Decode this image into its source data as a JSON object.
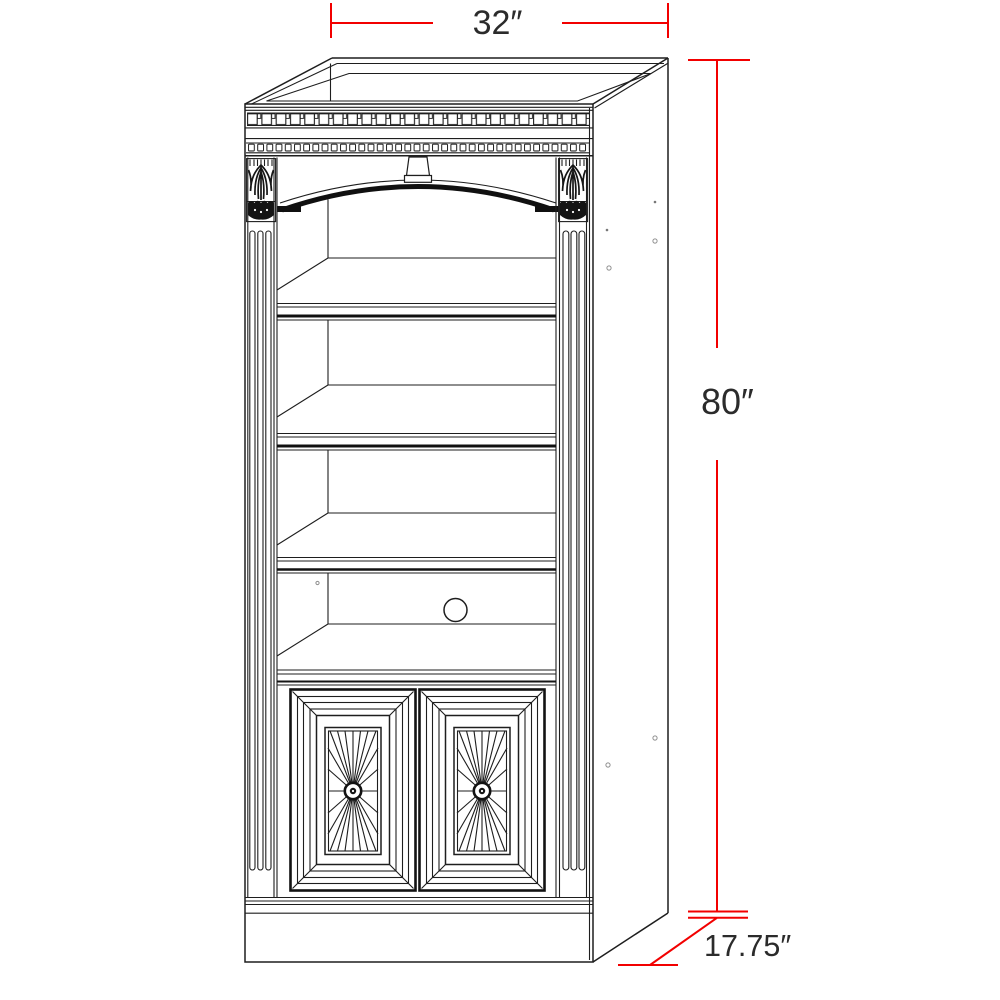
{
  "drawing": {
    "title": "Bookcase dimensional line drawing",
    "object": "tall bookcase with arched valance, three adjustable shelves, media opening with cable grommet, and two sunburst-panel doors",
    "background_color": "#ffffff",
    "line_color": "#1e1e1e",
    "dimension_line_color": "#f20000",
    "dimension_text_color": "#2b2b2b",
    "dimensions": {
      "width": {
        "label": "32″",
        "value": 32,
        "unit": "in"
      },
      "height": {
        "label": "80″",
        "value": 80,
        "unit": "in"
      },
      "depth": {
        "label": "17.75″",
        "value": 17.75,
        "unit": "in"
      }
    },
    "features": {
      "adjustable_shelves": 3,
      "fixed_shelves": 1,
      "doors": 2,
      "door_panel_style": "sunburst with center rosette",
      "cable_grommet": true,
      "crown_molding_dentil_rows": 2,
      "corbels": 2,
      "fluted_pilasters": 2,
      "keystone": true,
      "side_pin_holes": 6
    }
  }
}
